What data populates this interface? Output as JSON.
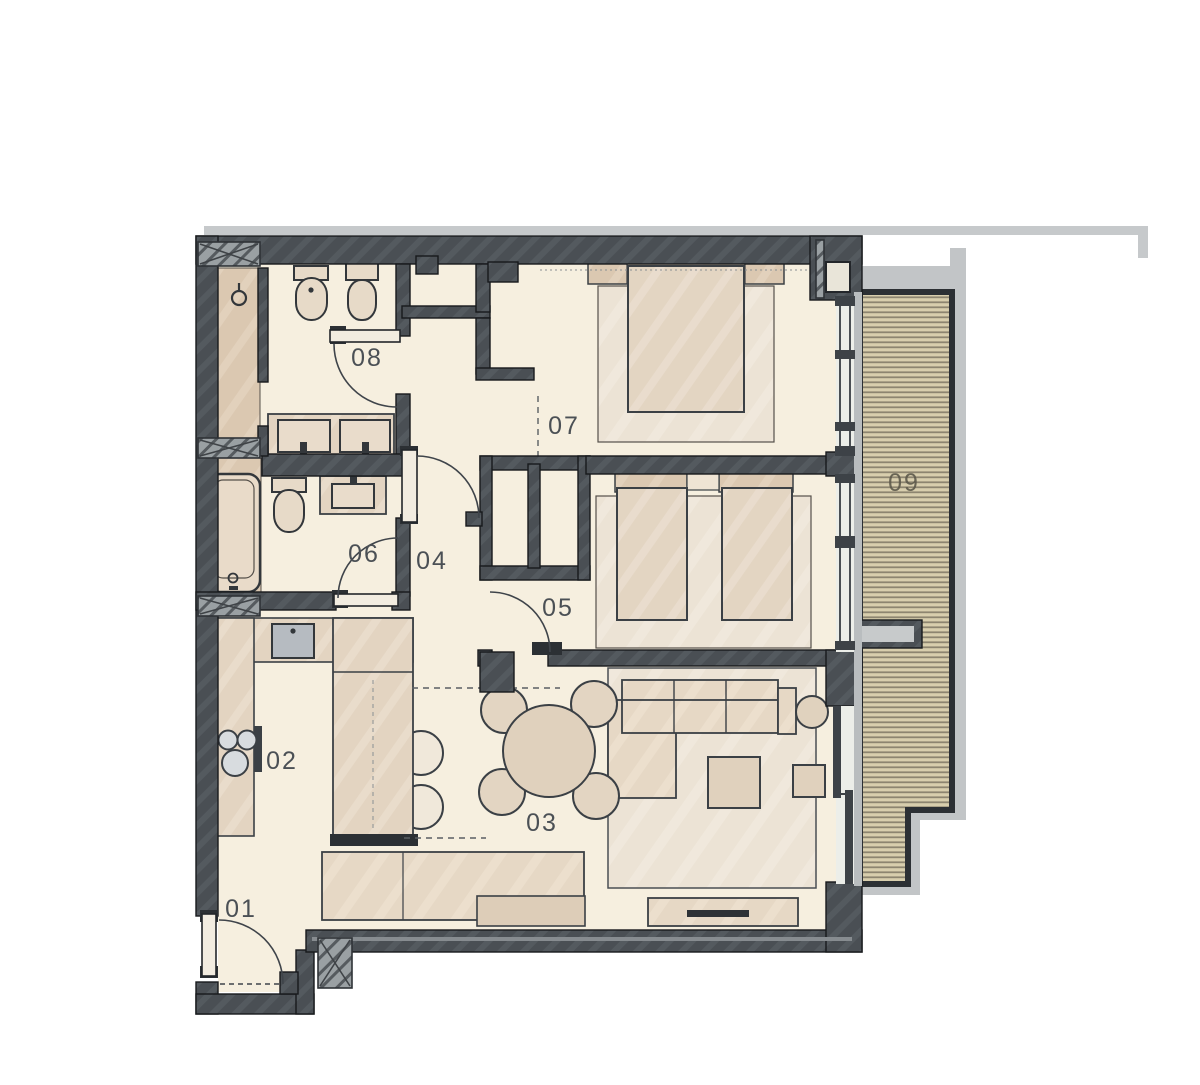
{
  "palette": {
    "wall": "#4a4f54",
    "floor": "#f6efdf",
    "furniture": "#e6d8c5",
    "wet_zone": "#dbc8b1",
    "counter": "#e3d4c1",
    "rug": "#ece3d5",
    "deck": "#d8cead",
    "concrete": "#c2c5c7",
    "sink": "#b6bbc1",
    "label": "#4b5055"
  },
  "rooms": [
    {
      "id": "01",
      "label": "01"
    },
    {
      "id": "02",
      "label": "02"
    },
    {
      "id": "03",
      "label": "03"
    },
    {
      "id": "04",
      "label": "04"
    },
    {
      "id": "05",
      "label": "05"
    },
    {
      "id": "06",
      "label": "06"
    },
    {
      "id": "07",
      "label": "07"
    },
    {
      "id": "08",
      "label": "08"
    },
    {
      "id": "09",
      "label": "09"
    }
  ]
}
